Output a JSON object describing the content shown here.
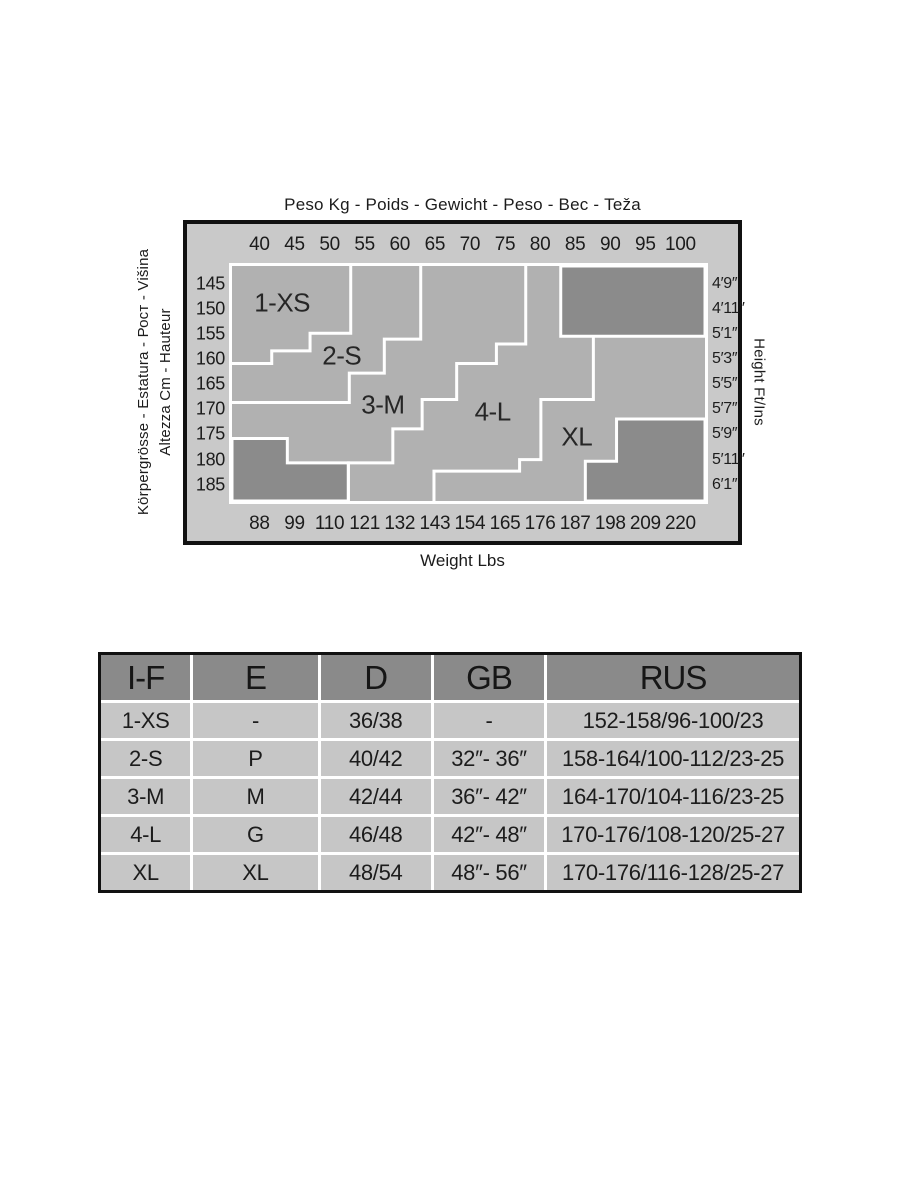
{
  "chart_data": {
    "type": "area",
    "title": "Peso Kg - Poids - Gewicht - Peso - Вес - Teža",
    "xlabel_top": "Peso Kg - Poids - Gewicht - Peso - Вес - Teža",
    "xlabel_bottom": "Weight Lbs",
    "ylabel_left_line_outer": "Körpergrösse - Estatura - Рост - Višina",
    "ylabel_left_line_inner": "Altezza Cm - Hauteur",
    "ylabel_right": "Height Ft/Ins",
    "x_ticks_kg": [
      "40",
      "45",
      "50",
      "55",
      "60",
      "65",
      "70",
      "75",
      "80",
      "85",
      "90",
      "95",
      "100"
    ],
    "x_ticks_lbs": [
      "88",
      "99",
      "110",
      "121",
      "132",
      "143",
      "154",
      "165",
      "176",
      "187",
      "198",
      "209",
      "220"
    ],
    "y_ticks_cm": [
      "145",
      "150",
      "155",
      "160",
      "165",
      "170",
      "175",
      "180",
      "185"
    ],
    "y_ticks_ftin": [
      "4′9″",
      "4′11″",
      "5′1″",
      "5′3″",
      "5′5″",
      "5′7″",
      "5′9″",
      "5′11″",
      "6′1″"
    ],
    "zones": [
      {
        "label": "1-XS",
        "label_x": 10.6,
        "label_y": 15.8
      },
      {
        "label": "2-S",
        "label_x": 23.2,
        "label_y": 38.2
      },
      {
        "label": "3-M",
        "label_x": 31.9,
        "label_y": 59.3
      },
      {
        "label": "4-L",
        "label_x": 55.1,
        "label_y": 62.2
      },
      {
        "label": "XL",
        "label_x": 72.9,
        "label_y": 72.6
      }
    ],
    "boundaries": [
      [
        [
          25.1,
          0
        ],
        [
          25.1,
          28.6
        ],
        [
          16.5,
          28.6
        ],
        [
          16.5,
          36.1
        ],
        [
          8.4,
          36.1
        ],
        [
          8.4,
          41.5
        ],
        [
          0,
          41.5
        ]
      ],
      [
        [
          39.9,
          0
        ],
        [
          39.9,
          31.1
        ],
        [
          32.2,
          31.1
        ],
        [
          32.2,
          45.6
        ],
        [
          24.8,
          45.6
        ],
        [
          24.8,
          58.1
        ],
        [
          0,
          58.1
        ]
      ],
      [
        [
          62.1,
          0
        ],
        [
          62.1,
          33.2
        ],
        [
          55.9,
          33.2
        ],
        [
          55.9,
          41.5
        ],
        [
          47.5,
          41.5
        ],
        [
          47.5,
          56.8
        ],
        [
          40.2,
          56.8
        ],
        [
          40.2,
          69.3
        ],
        [
          34,
          69.3
        ],
        [
          34,
          83.8
        ],
        [
          24.6,
          83.8
        ],
        [
          24.6,
          100
        ]
      ],
      [
        [
          76.4,
          29.9
        ],
        [
          76.4,
          56.8
        ],
        [
          65.3,
          56.8
        ],
        [
          65.3,
          82.4
        ],
        [
          60.8,
          82.4
        ],
        [
          60.8,
          87.3
        ],
        [
          42.7,
          87.3
        ],
        [
          42.7,
          100
        ]
      ]
    ],
    "excluded_zones": [
      [
        [
          69.5,
          0
        ],
        [
          100,
          0
        ],
        [
          100,
          29.9
        ],
        [
          69.5,
          29.9
        ]
      ],
      [
        [
          0,
          73.4
        ],
        [
          11.7,
          73.4
        ],
        [
          11.7,
          83.8
        ],
        [
          24.6,
          83.8
        ],
        [
          24.6,
          100
        ],
        [
          0,
          100
        ]
      ],
      [
        [
          81.3,
          65.1
        ],
        [
          100,
          65.1
        ],
        [
          100,
          100
        ],
        [
          74.7,
          100
        ],
        [
          74.7,
          83.1
        ],
        [
          81.3,
          83.1
        ]
      ]
    ],
    "layout": {
      "tick_x0": 5.8,
      "tick_dx": 7.417,
      "tick_y0": 7.5,
      "tick_dy": 10.7,
      "grid": false,
      "legend": false
    },
    "colors": {
      "outer_bg": "#c9c9c9",
      "plot_bg": "#b1b1b1",
      "excluded_zone": "#8b8b8b",
      "boundary_line": "#ffffff",
      "frame_border": "#111111",
      "table_header_bg": "#8a8a8a",
      "table_row_bg": "#c6c6c6"
    }
  },
  "table": {
    "headers": [
      "I-F",
      "E",
      "D",
      "GB",
      "RUS"
    ],
    "rows": [
      [
        "1-XS",
        "-",
        "36/38",
        "-",
        "152-158/96-100/23"
      ],
      [
        "2-S",
        "P",
        "40/42",
        "32″- 36″",
        "158-164/100-112/23-25"
      ],
      [
        "3-M",
        "M",
        "42/44",
        "36″- 42″",
        "164-170/104-116/23-25"
      ],
      [
        "4-L",
        "G",
        "46/48",
        "42″- 48″",
        "170-176/108-120/25-27"
      ],
      [
        "XL",
        "XL",
        "48/54",
        "48″- 56″",
        "170-176/116-128/25-27"
      ]
    ]
  }
}
